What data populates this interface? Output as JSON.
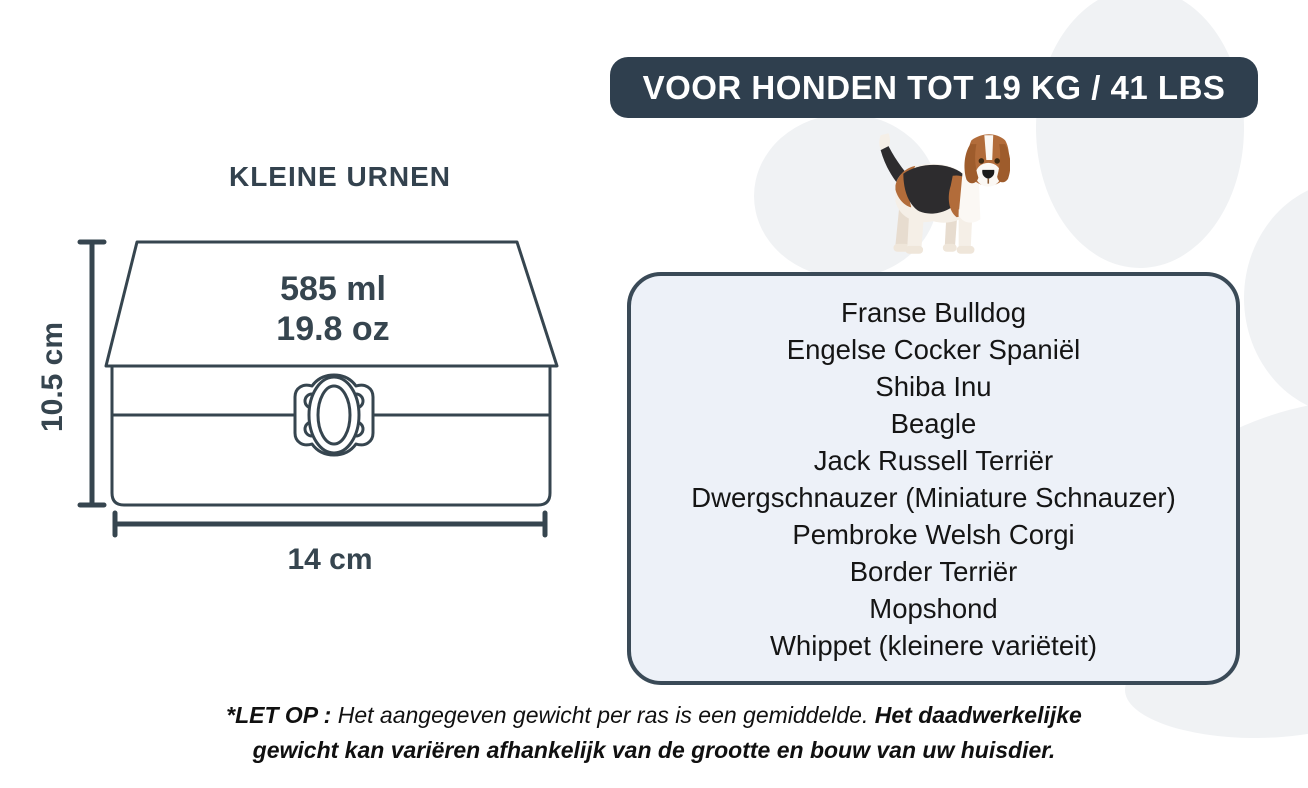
{
  "banner": {
    "label": "VOOR HONDEN TOT 19 KG / 41 LBS"
  },
  "urn": {
    "title": "KLEINE URNEN",
    "volume_ml": "585 ml",
    "volume_oz": "19.8 oz",
    "height_label": "10.5 cm",
    "width_label": "14 cm"
  },
  "breeds": {
    "items": [
      "Franse Bulldog",
      "Engelse Cocker Spaniël",
      "Shiba Inu",
      "Beagle",
      "Jack Russell Terriër",
      "Dwergschnauzer (Miniature Schnauzer)",
      "Pembroke Welsh Corgi",
      "Border Terriër",
      "Mopshond",
      "Whippet (kleinere variëteit)"
    ]
  },
  "note": {
    "prefix": "*LET OP :",
    "middle": "Het aangegeven gewicht per ras is een gemiddelde.",
    "emphasis": "Het daadwerkelijke gewicht kan variëren afhankelijk van de grootte en bouw van uw huisdier."
  },
  "colors": {
    "banner_bg": "#2f3f4e",
    "banner_text": "#ffffff",
    "diagram_stroke": "#36454f",
    "panel_border": "#3a4a57",
    "panel_fill": "#edf1f8",
    "breed_text": "#151515",
    "paw_watermark": "#f0f2f4",
    "dog_tan": "#b26c3a",
    "dog_dark_patch": "#2d2c2e",
    "dog_cream": "#f5efe7"
  }
}
